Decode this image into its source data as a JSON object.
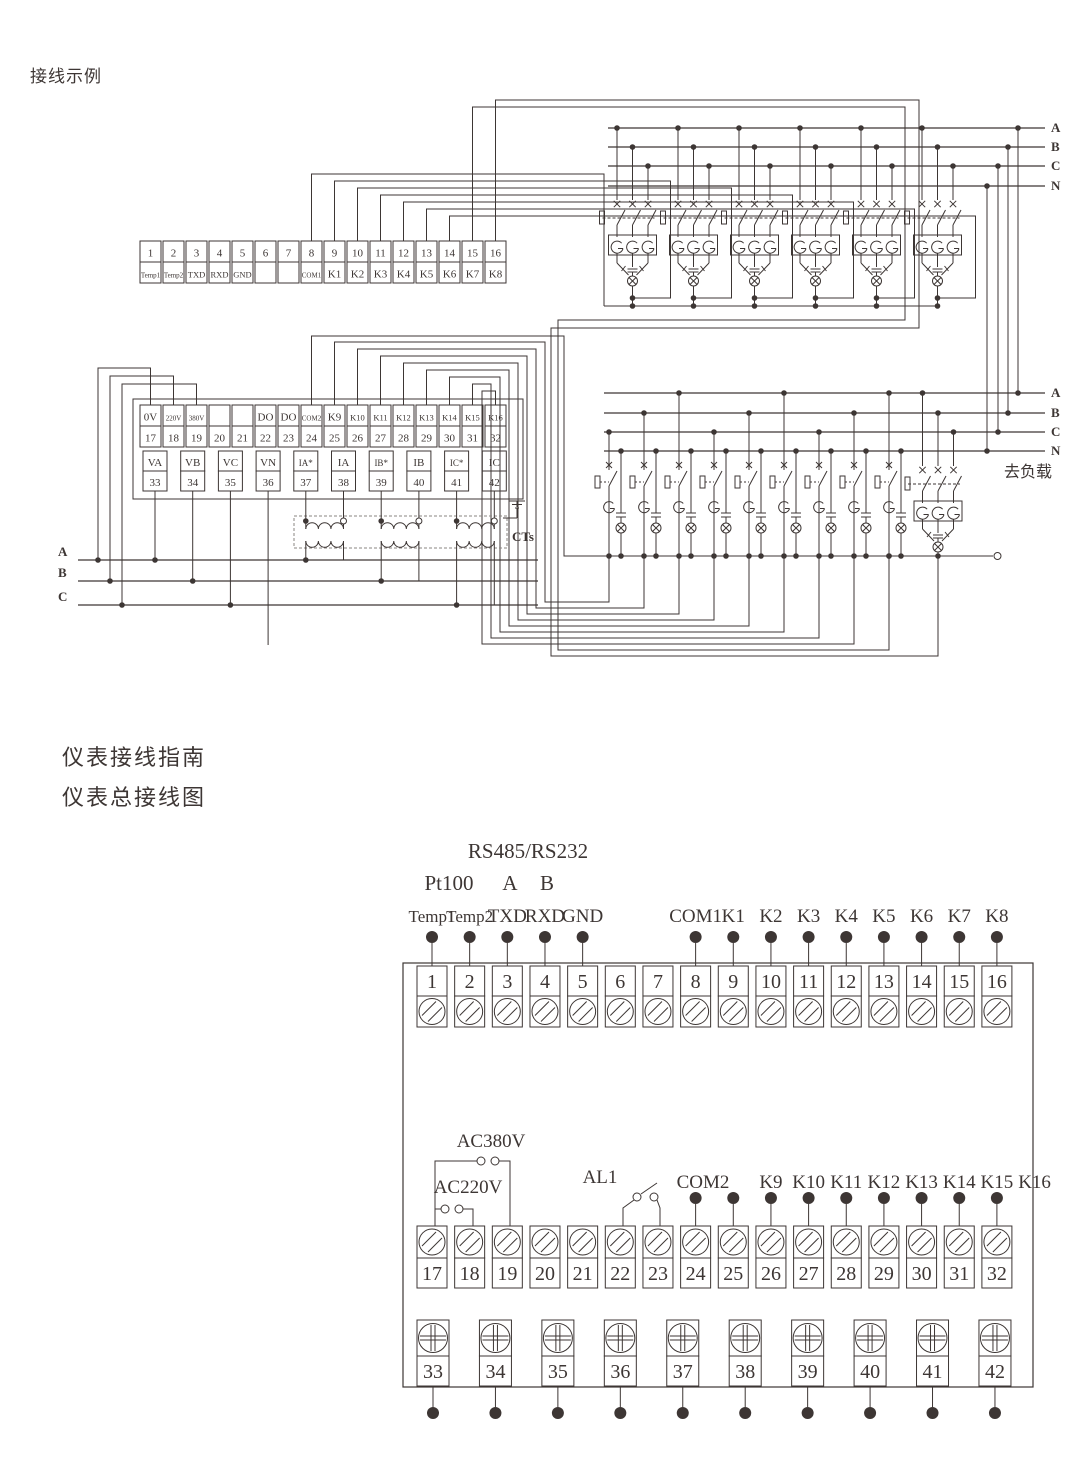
{
  "page": {
    "top_title": "接线示例",
    "heading1": "仪表接线指南",
    "heading2": "仪表总接线图"
  },
  "top_diagram": {
    "strip1": {
      "numbers": [
        "1",
        "2",
        "3",
        "4",
        "5",
        "6",
        "7",
        "8",
        "9",
        "10",
        "11",
        "12",
        "13",
        "14",
        "15",
        "16"
      ],
      "labels": [
        "Temp1",
        "Temp2",
        "TXD",
        "RXD",
        "GND",
        "",
        "",
        "COM1",
        "K1",
        "K2",
        "K3",
        "K4",
        "K5",
        "K6",
        "K7",
        "K8"
      ]
    },
    "strip2": {
      "numbers": [
        "17",
        "18",
        "19",
        "20",
        "21",
        "22",
        "23",
        "24",
        "25",
        "26",
        "27",
        "28",
        "29",
        "30",
        "31",
        "32"
      ],
      "labels": [
        "0V",
        "220V",
        "380V",
        "",
        "",
        "DO",
        "DO",
        "COM2",
        "K9",
        "K10",
        "K11",
        "K12",
        "K13",
        "K14",
        "K15",
        "K16"
      ]
    },
    "strip3": {
      "numbers": [
        "33",
        "34",
        "35",
        "36",
        "37",
        "38",
        "39",
        "40",
        "41",
        "42"
      ],
      "labels": [
        "VA",
        "VB",
        "VC",
        "VN",
        "IA*",
        "IA",
        "IB*",
        "IB",
        "IC*",
        "IC"
      ]
    },
    "bus1_labels": [
      "A",
      "B",
      "C",
      "N"
    ],
    "bus2_labels": [
      "A",
      "B",
      "C",
      "N"
    ],
    "left_bus_labels": [
      "A",
      "B",
      "C"
    ],
    "cts_label": "CTs",
    "load_label": "去负载"
  },
  "bottom_diagram": {
    "rs_label": "RS485/RS232",
    "pt_label": "Pt100",
    "a_label": "A",
    "b_label": "B",
    "row1_left_labels": [
      "Temp1",
      "Temp2",
      "TXD",
      "RXD",
      "GND"
    ],
    "row1_right_labels": [
      "COM1",
      "K1",
      "K2",
      "K3",
      "K4",
      "K5",
      "K6",
      "K7",
      "K8"
    ],
    "ac380_label": "AC380V",
    "ac220_label": "AC220V",
    "al1_label": "AL1",
    "row2_labels": [
      "COM2",
      "K9",
      "K10",
      "K11",
      "K12",
      "K13",
      "K14",
      "K15",
      "K16"
    ],
    "row1_numbers": [
      "1",
      "2",
      "3",
      "4",
      "5",
      "6",
      "7",
      "8",
      "9",
      "10",
      "11",
      "12",
      "13",
      "14",
      "15",
      "16"
    ],
    "row2_numbers": [
      "17",
      "18",
      "19",
      "20",
      "21",
      "22",
      "23",
      "24",
      "25",
      "26",
      "27",
      "28",
      "29",
      "30",
      "31",
      "32"
    ],
    "row3_numbers": [
      "33",
      "34",
      "35",
      "36",
      "37",
      "38",
      "39",
      "40",
      "41",
      "42"
    ]
  }
}
